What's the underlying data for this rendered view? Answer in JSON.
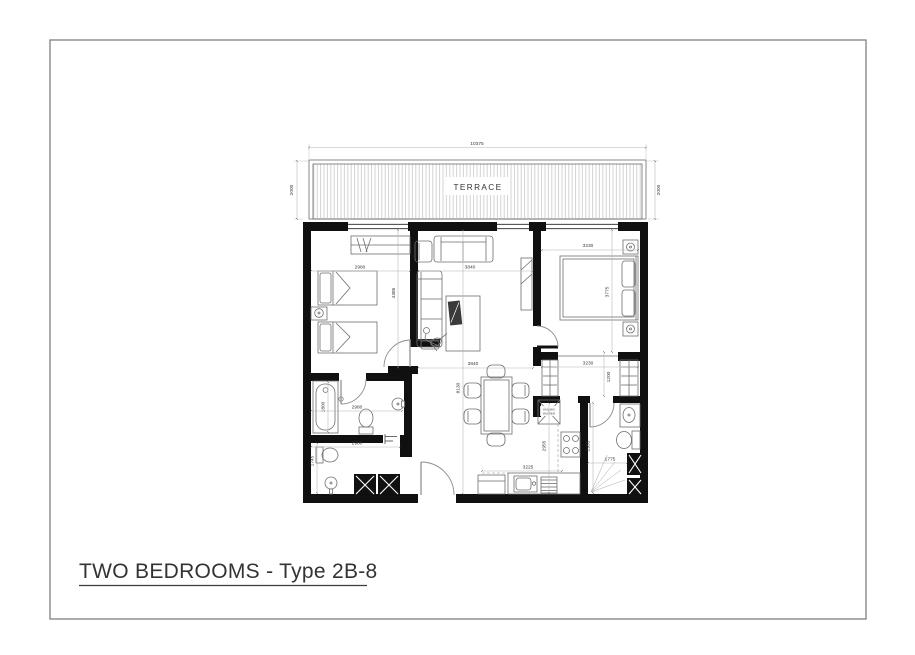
{
  "window": {
    "title": "TWO BEDROOMS - Type 2B-8"
  },
  "floor_plan": {
    "terrace": {
      "label": "TERRACE",
      "width_dim": "10375",
      "depth_dim_left": "2000",
      "depth_dim_right": "2000"
    },
    "appliances": {
      "washing_machine_line1": "WASHING",
      "washing_machine_line2": "MACHINE"
    },
    "dimensions": {
      "bedroom_width": "2980",
      "bedroom_depth": "4385",
      "living_width": "3840",
      "living_lower_width": "3840",
      "overall_depth": "8130",
      "master_width": "3230",
      "master_depth": "3775",
      "closet_width": "3230",
      "closet_depth": "1200",
      "bathtub_length": "1800",
      "bathroom_width": "2980",
      "wc_width": "2980",
      "wc_length": "1745",
      "kitchen_depth": "2955",
      "kitchen_width": "3225",
      "bathroom2_depth": "2955",
      "bathroom2_width": "1775"
    }
  },
  "colors": {
    "wall": "#101010",
    "dim_text": "#3a3a3a",
    "furniture": "#6e6e6e",
    "hatch": "#c9c9c9",
    "page_border": "#808080",
    "underline": "#3c3c3c"
  }
}
